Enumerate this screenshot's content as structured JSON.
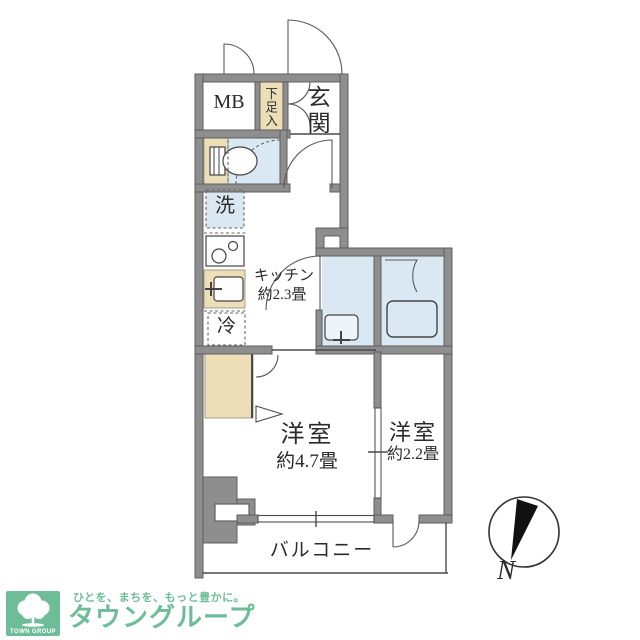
{
  "plan": {
    "mb": "MB",
    "shoe": "下足入",
    "genkan": "玄関",
    "washer": "洗",
    "kitchen": "キッチン",
    "kitchen_size": "約2.3畳",
    "fridge": "冷",
    "main_room": "洋室",
    "main_room_size": "約4.7畳",
    "sub_room": "洋室",
    "sub_room_size": "約2.2畳",
    "balcony": "バルコニー",
    "compass": "N"
  },
  "branding": {
    "logo_text": "タウングループ",
    "tagline": "ひとを、まちを、もっと豊かに。",
    "logo_box_label": "TOWN GROUP"
  },
  "colors": {
    "wall": "#8e8e8e",
    "wall_dark": "#5f5f5f",
    "water_blue": "#d9e8f2",
    "cabinet_beige": "#ecdfb7",
    "brand_green": "#6fbd98",
    "line": "#4a4a4a"
  }
}
